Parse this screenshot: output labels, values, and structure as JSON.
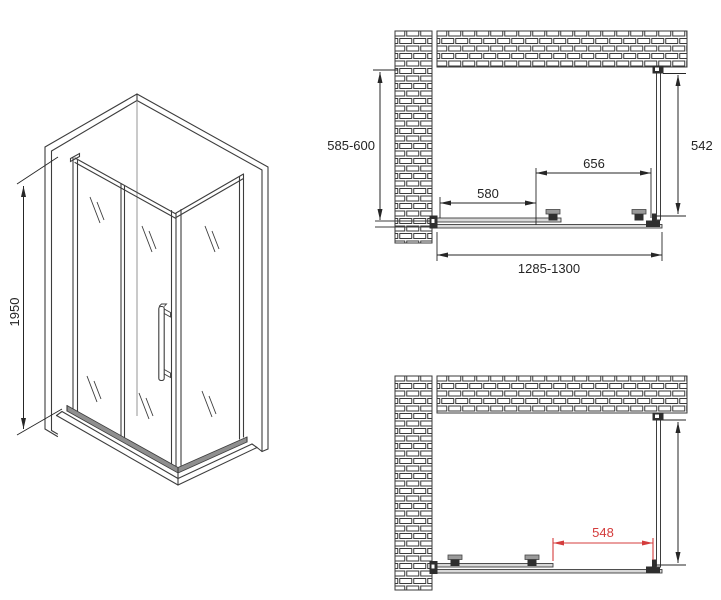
{
  "drawing": {
    "subject": "shower-enclosure-technical-drawing",
    "colors": {
      "line": "#3d3d3d",
      "dimension": "#262626",
      "accent_red": "#d43c3c",
      "background": "#ffffff"
    },
    "iso": {
      "height_label": "1950"
    },
    "plan_closed": {
      "depth_label": "585-600",
      "glass_depth_label": "542",
      "door_width_label": "656",
      "fixed_width_label": "580",
      "overall_width_label": "1285-1300"
    },
    "plan_open": {
      "opening_label": "548"
    }
  }
}
